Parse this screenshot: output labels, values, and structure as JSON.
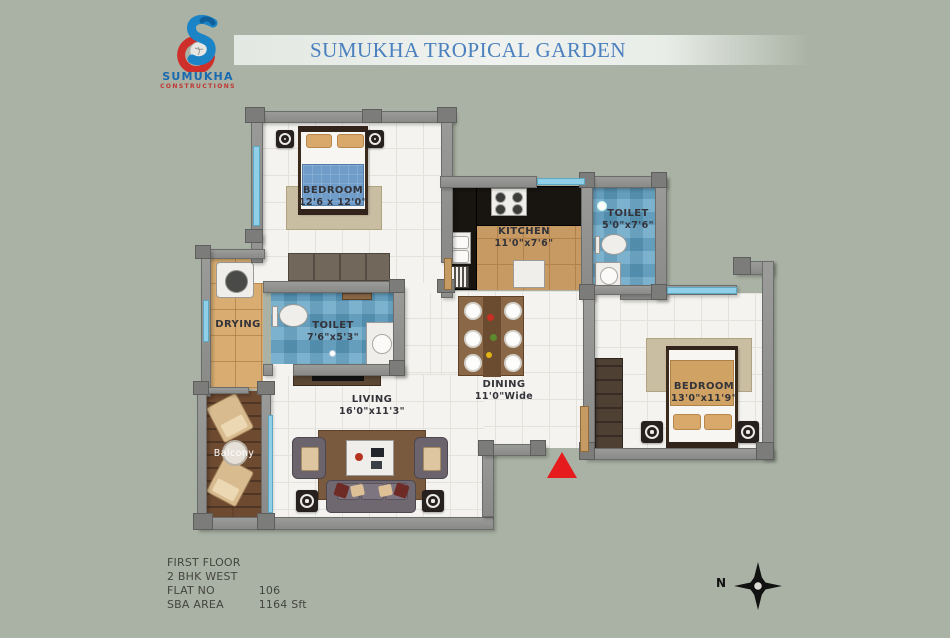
{
  "header": {
    "title": "SUMUKHA TROPICAL GARDEN"
  },
  "logo": {
    "name": "SUMUKHA",
    "subtitle": "CONSTRUCTIONS"
  },
  "rooms": {
    "bedroom1": {
      "label": "BEDROOM",
      "dims": "12'6 x 12'0\""
    },
    "kitchen": {
      "label": "KITCHEN",
      "dims": "11'0\"x7'6\""
    },
    "toilet_attached": {
      "label": "TOILET",
      "dims": "5'0\"x7'6\""
    },
    "toilet_common": {
      "label": "TOILET",
      "dims": "7'6\"x5'3\""
    },
    "drying": {
      "label": "DRYING"
    },
    "living": {
      "label": "LIVING",
      "dims": "16'0\"x11'3\""
    },
    "dining": {
      "label": "DINING",
      "dims": "11'0\"Wide"
    },
    "bedroom2": {
      "label": "BEDROOM",
      "dims": "13'0\"x11'9\""
    },
    "balcony": {
      "label": "Balcony"
    }
  },
  "info": {
    "floor": "FIRST FLOOR",
    "type": "2 BHK WEST",
    "flat_label": "FLAT NO",
    "flat_value": "106",
    "sba_label": "SBA  AREA",
    "sba_value": "1164 Sft"
  },
  "compass": {
    "north_label": "N"
  },
  "colors": {
    "background": "#a9b2a4",
    "title_blue": "#4b80bf",
    "logo_blue": "#1a6ab0",
    "logo_red": "#c23531",
    "wall": "#8f908e",
    "floor": "#f4f3ef",
    "kitchen_floor": "#c79a63",
    "toilet_tile": "#68a6c6",
    "balcony_wood": "#6e4a31",
    "window": "#8fd0e8",
    "entry_marker": "#e51b1d"
  }
}
